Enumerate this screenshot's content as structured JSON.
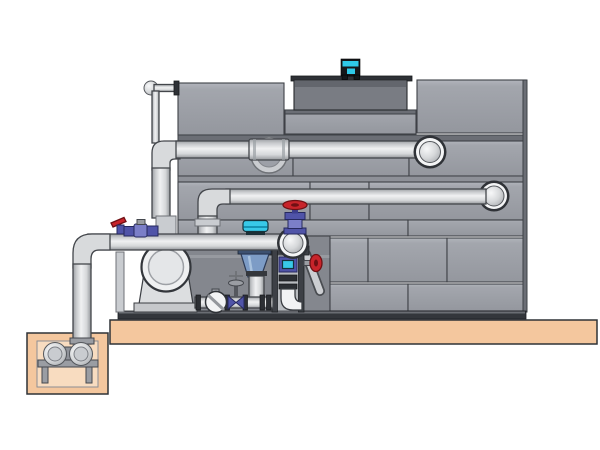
{
  "scene": {
    "label": "Industrial cooling tower with circulation pump skid, filtration unit and sump pit",
    "components": [
      "cooling-tower",
      "fan-cowl",
      "fan-motor",
      "tower-panels",
      "hot-water-return-pipe",
      "cold-water-supply-pipe",
      "equalizer-pipe",
      "pump-skid",
      "circulation-pump",
      "filtration-separator",
      "sight-glass",
      "gate-valve",
      "globe-valve",
      "red-handwheel-valve",
      "blue-valve-manifold",
      "control-frame",
      "suction-line",
      "sump-pit",
      "sump-pump",
      "concrete-slab"
    ]
  },
  "colors": {
    "background": "#ffffff",
    "panel": "#9da0a8",
    "panel_light": "#b3b6bd",
    "panel_dark": "#6b6e75",
    "panel_sep": "#8e9198",
    "panel_stroke": "#3e4146",
    "bay": "#84878e",
    "cowl": "#797c83",
    "cowl_flange": "#2e3136",
    "motor_cyan": "#2fc9e8",
    "motor_dark": "#15171a",
    "pipe_mid": "#d8dadc",
    "pipe_stroke": "#43464b",
    "ball_rim": "#2f3237",
    "ball_white": "#f4f5f6",
    "slab": "#f4c79e",
    "slab_light": "#f8dcc0",
    "slab_stroke": "#2f3237",
    "metal": "#9a9da3",
    "metal_dark": "#45484e",
    "light_metal": "#c9ccd0",
    "white_part": "#f2f3f4",
    "valve_blue": "#5054a8",
    "valve_blue_light": "#7b7fc8",
    "valve_navy": "#26295e",
    "cyan": "#38c9e8",
    "red": "#c8242b",
    "red_dark": "#701014",
    "cone_blue": "#7d9cc6",
    "cone_dark": "#3d5170",
    "instrument": "#2c2f34",
    "frame": "#3d4046",
    "base": "#33363b"
  }
}
